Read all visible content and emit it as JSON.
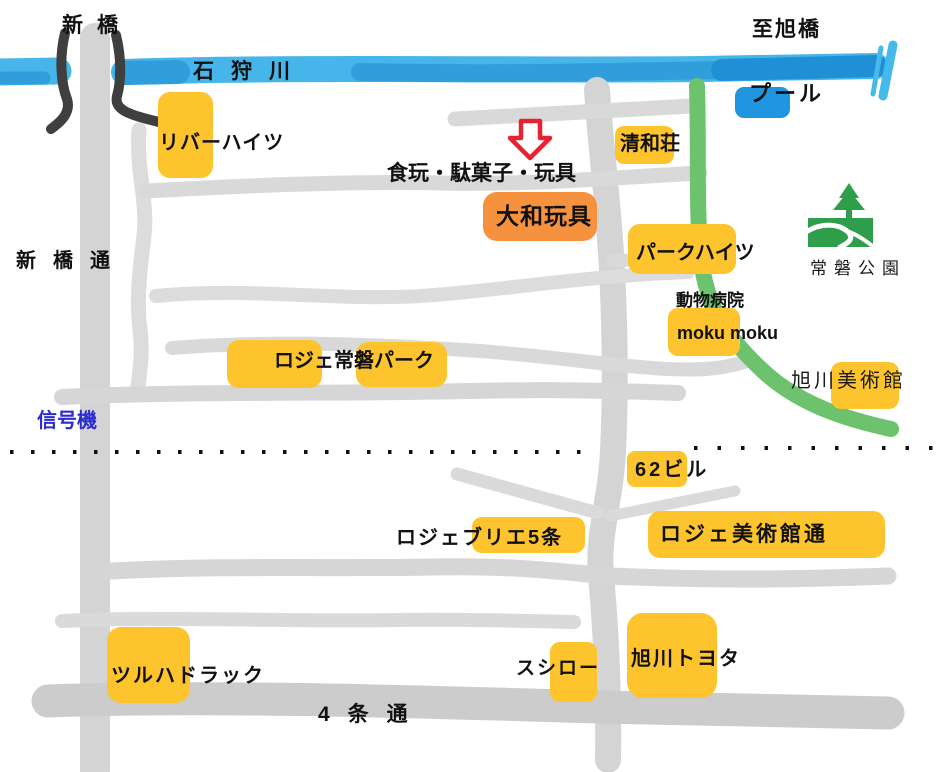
{
  "labels": {
    "shinbashi": "新橋",
    "ishikari_river": "石狩川",
    "to_asahibashi": "至旭橋",
    "pool": "プール",
    "river_heights": "リバーハイツ",
    "seiwaso": "清和荘",
    "shop_caption": "食玩・駄菓子・玩具",
    "yamato_toys": "大和玩具",
    "park_heights": "パークハイツ",
    "tokiwa_park": "常磐公園",
    "shinbashi_dori": "新橋通",
    "animal_hospital": "動物病院",
    "moku_moku": "moku moku",
    "roger_tokiwa_park": "ロジェ常磐パーク",
    "asahikawa_museum": "旭川美術館",
    "signal": "信号機",
    "bldg62": "62ビル",
    "roger_brie_5jo": "ロジェブリエ5条",
    "roger_museum_dori": "ロジェ美術館通",
    "tsuruha_drug": "ツルハドラック",
    "sushiro": "スシロー",
    "asahikawa_toyota": "旭川トヨタ",
    "yojo_dori": "4条通"
  },
  "colors": {
    "landmark_yellow": "#fdc42d",
    "shop_orange": "#f6913e",
    "pool_blue": "#2095e0",
    "river_light_blue": "#46b5e9",
    "river_dark_blue": "#1f90d6",
    "greenway_green": "#6cc26d",
    "park_icon_green": "#2f9e4a",
    "road_gray": "#d9d9d9",
    "arrow_red": "#e8222f",
    "signal_text_blue": "#2b2bd0"
  }
}
